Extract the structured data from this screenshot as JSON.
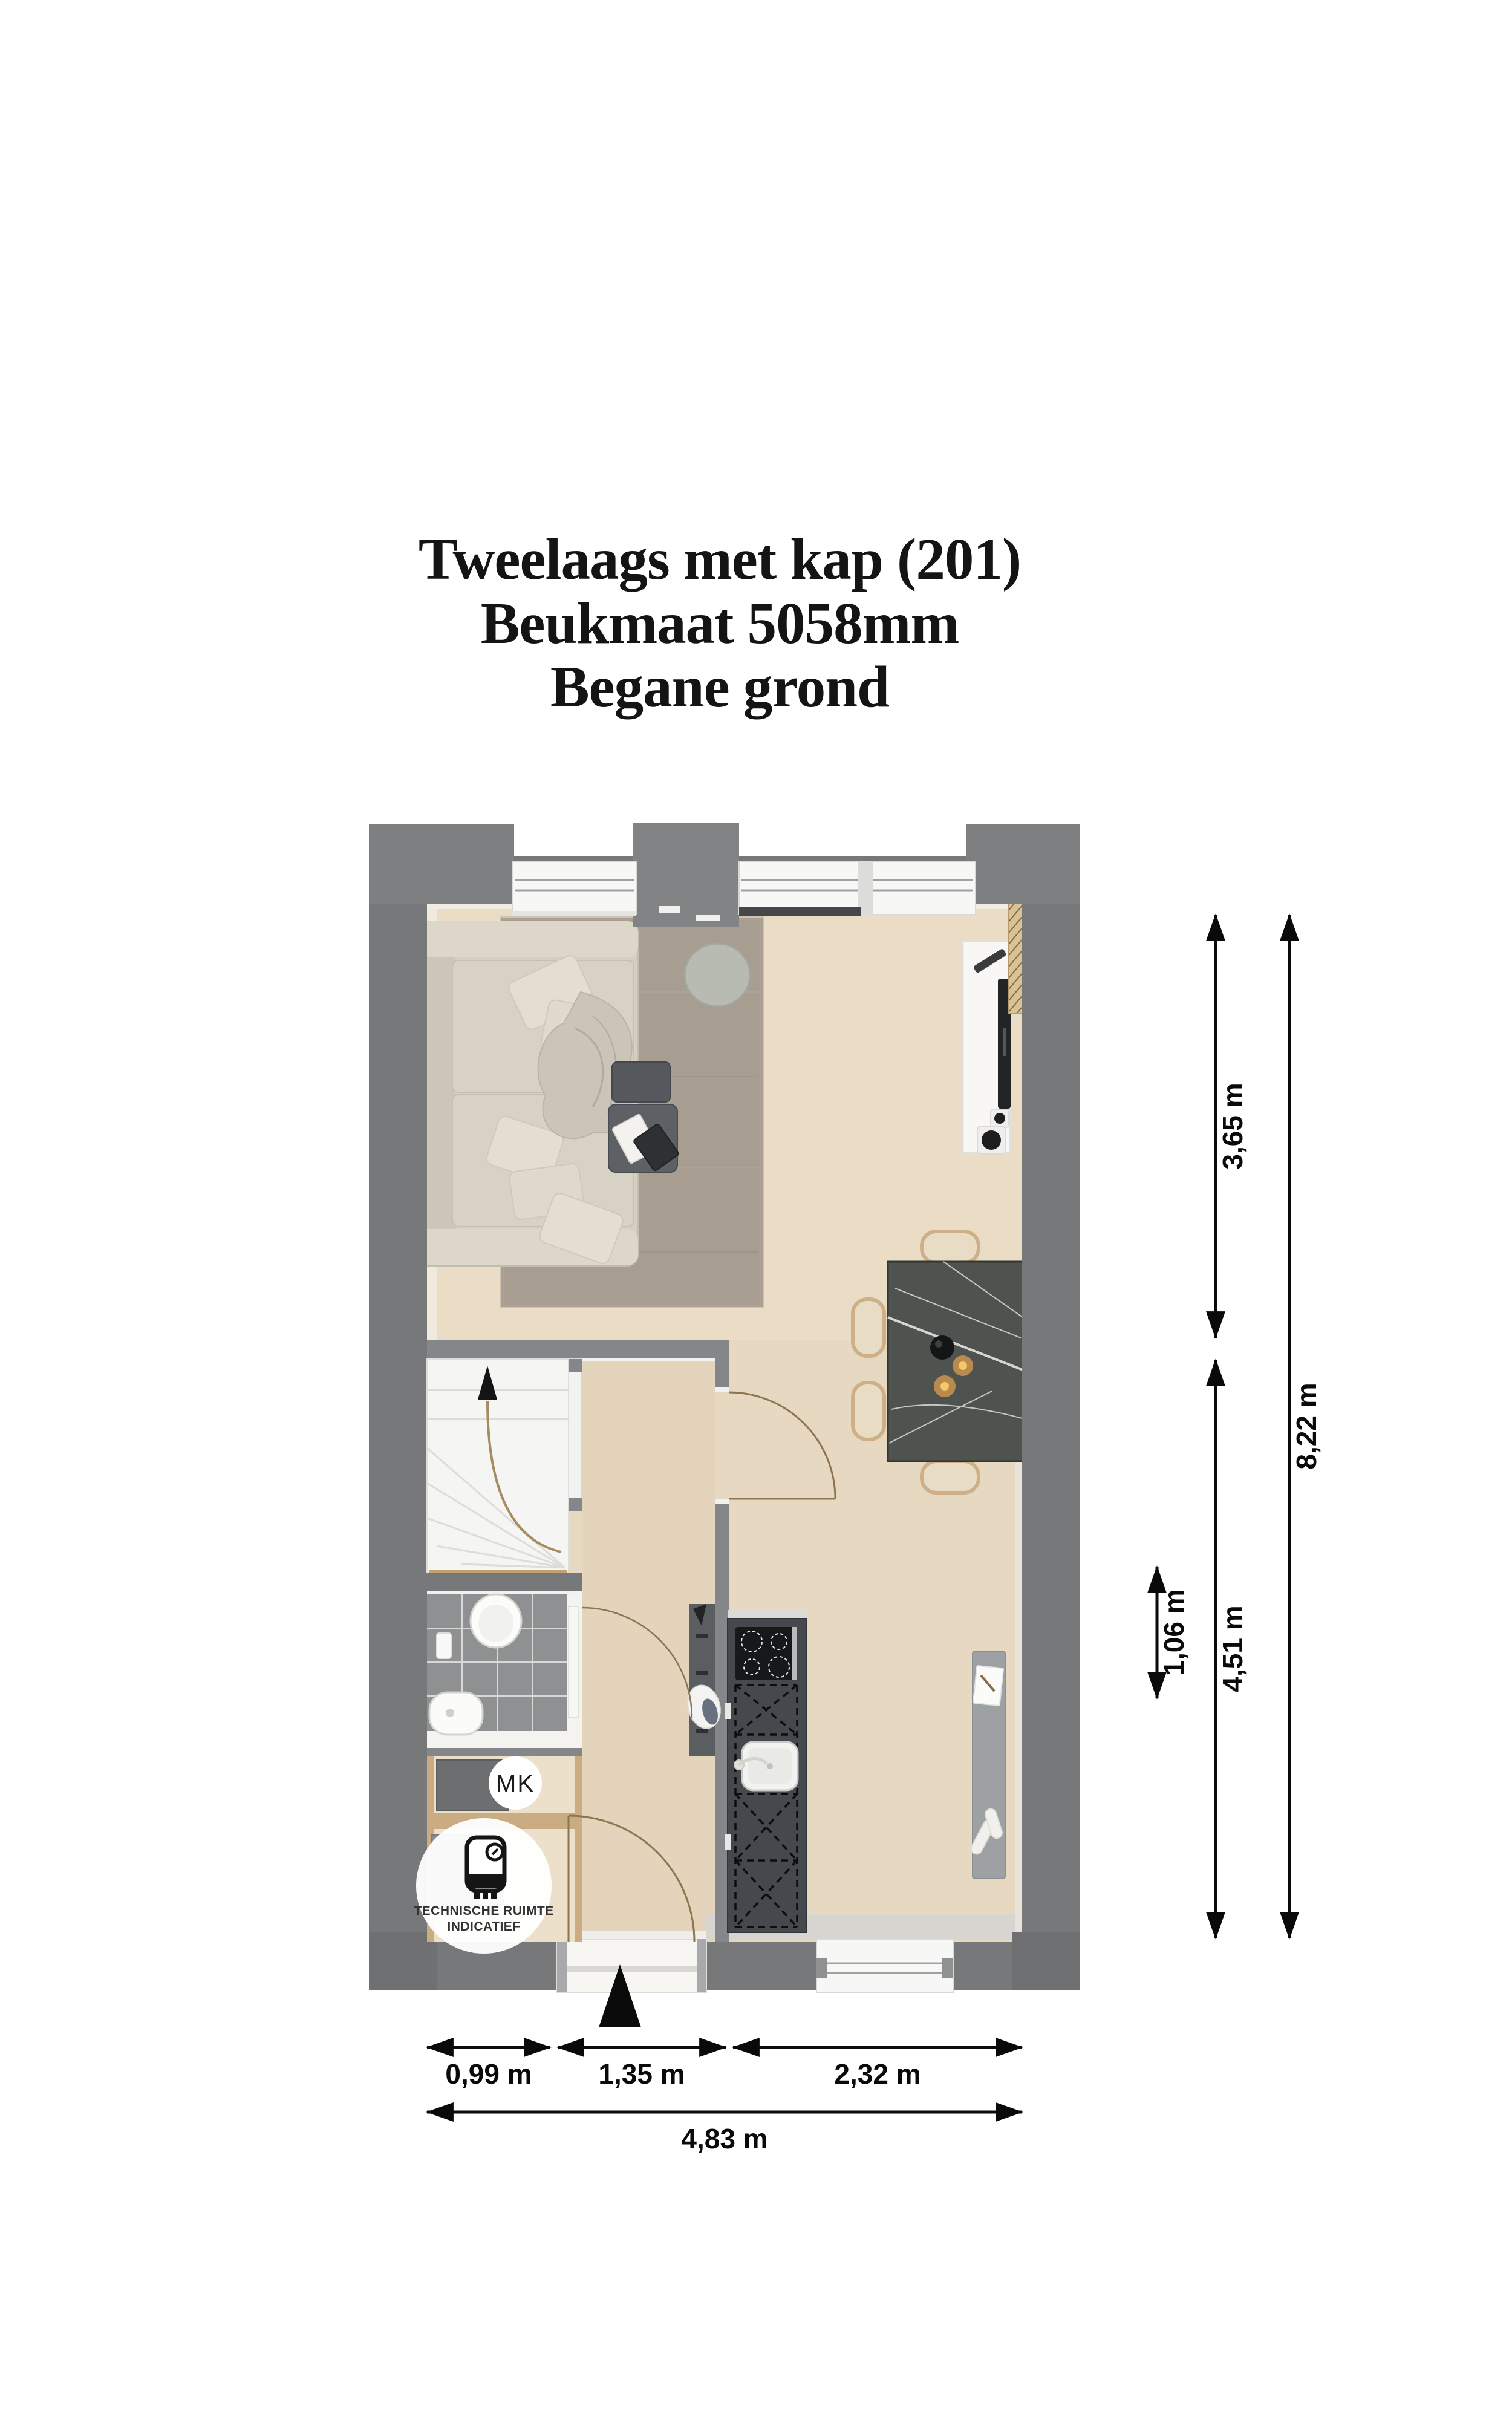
{
  "title": {
    "line1": "Tweelaags met kap (201)",
    "line2": "Beukmaat 5058mm",
    "line3": "Begane grond"
  },
  "labels": {
    "mk": "MK",
    "tech_line1": "TECHNISCHE RUIMTE",
    "tech_line2": "INDICATIEF"
  },
  "dims": {
    "v365": "3,65 m",
    "v451": "4,51 m",
    "v106": "1,06 m",
    "v822": "8,22 m",
    "h099": "0,99 m",
    "h135": "1,35 m",
    "h232": "2,32 m",
    "h483": "4,83 m"
  },
  "colors": {
    "wall": "#77787a",
    "floor": "#e7d8c1",
    "rug": "#a79d91",
    "kitchen_counter": "#45494e",
    "dining_table": "#4e534f",
    "wood_trim": "#c9ac82",
    "dimension": "#0a0a0a"
  }
}
